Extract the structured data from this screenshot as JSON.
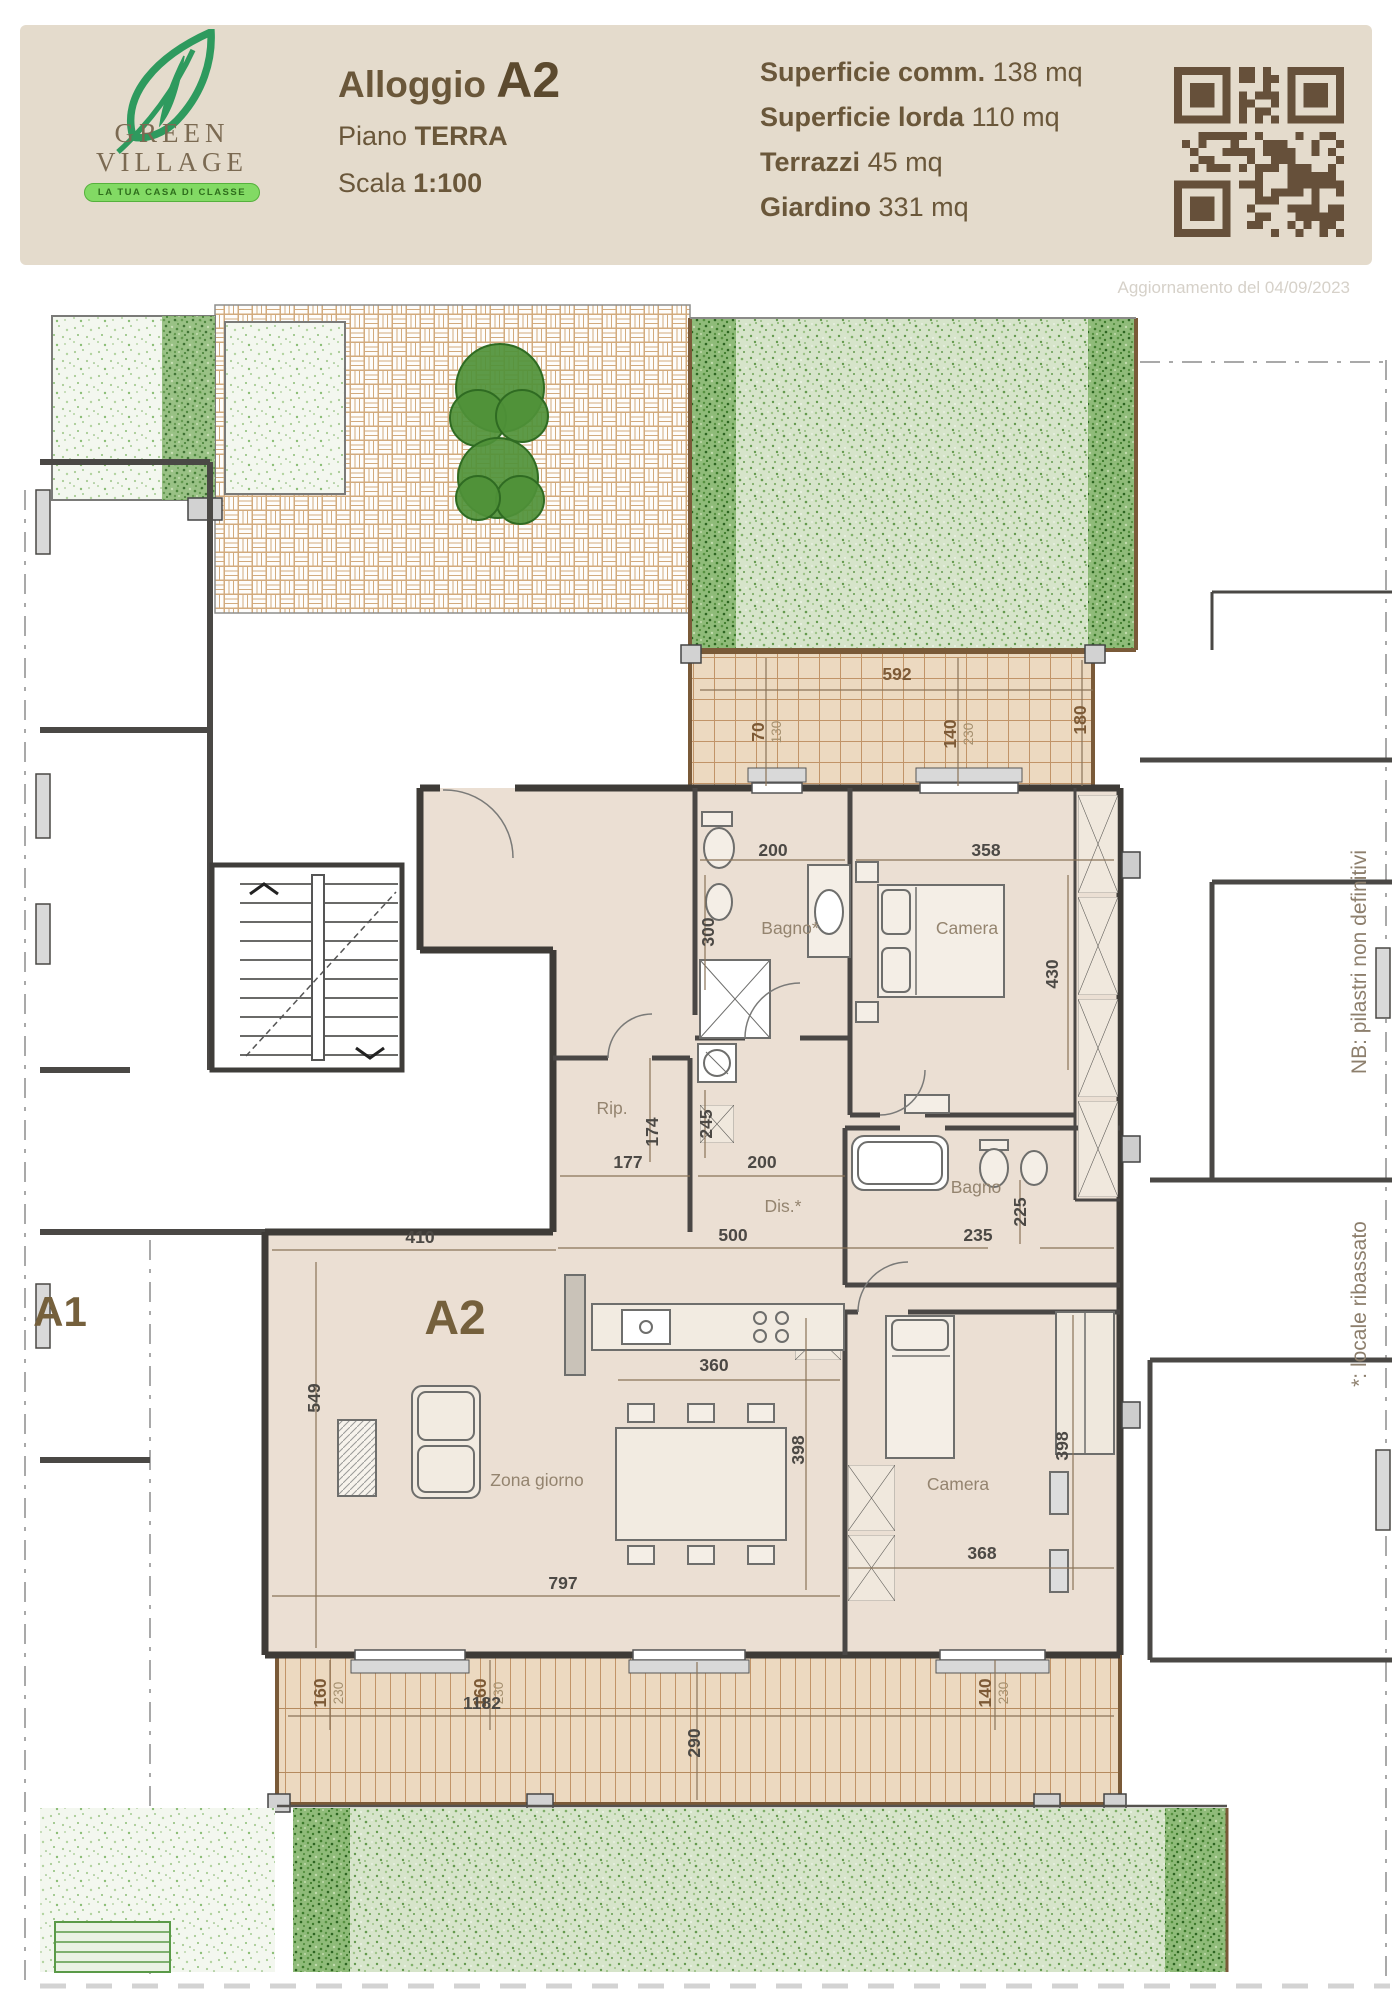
{
  "header": {
    "logo": {
      "name_line1": "GREEN",
      "name_line2": "VILLAGE",
      "tagline": "LA TUA CASA DI CLASSE"
    },
    "title": {
      "label": "Alloggio",
      "value": "A2"
    },
    "floor": {
      "label": "Piano",
      "value": "TERRA"
    },
    "scale": {
      "label": "Scala",
      "value": "1:100"
    },
    "stats": [
      {
        "label": "Superficie comm.",
        "value": "138 mq"
      },
      {
        "label": "Superficie lorda",
        "value": "110 mq"
      },
      {
        "label": "Terrazzi",
        "value": "45 mq"
      },
      {
        "label": "Giardino",
        "value": "331 mq"
      }
    ],
    "qr_icon": "qr-code"
  },
  "plan": {
    "update_note": "Aggiornamento del 04/09/2023",
    "unit_labels": [
      {
        "t": "A2",
        "x": 455,
        "y": 1034,
        "fs": 48
      },
      {
        "t": "A1",
        "x": 60,
        "y": 1026,
        "fs": 42
      }
    ],
    "rooms": [
      {
        "t": "Bagno*",
        "x": 790,
        "y": 634
      },
      {
        "t": "Camera",
        "x": 967,
        "y": 634
      },
      {
        "t": "Rip.",
        "x": 612,
        "y": 814
      },
      {
        "t": "Dis.*",
        "x": 783,
        "y": 912
      },
      {
        "t": "Bagno",
        "x": 976,
        "y": 893
      },
      {
        "t": "Zona giorno",
        "x": 537,
        "y": 1186
      },
      {
        "t": "Camera",
        "x": 958,
        "y": 1190
      }
    ],
    "dimensions": [
      {
        "t": "592",
        "x": 897,
        "y": 380,
        "c": "b"
      },
      {
        "t": "70",
        "t2": "130",
        "x": 764,
        "y": 432,
        "r": 1,
        "c": "b"
      },
      {
        "t": "140",
        "t2": "230",
        "x": 956,
        "y": 434,
        "r": 1,
        "c": "b"
      },
      {
        "t": "180",
        "x": 1086,
        "y": 420,
        "r": 1,
        "c": "b"
      },
      {
        "t": "200",
        "x": 773,
        "y": 556,
        "c": "g"
      },
      {
        "t": "358",
        "x": 986,
        "y": 556,
        "c": "g"
      },
      {
        "t": "300",
        "x": 714,
        "y": 632,
        "r": 1,
        "c": "g"
      },
      {
        "t": "430",
        "x": 1058,
        "y": 674,
        "r": 1,
        "c": "g"
      },
      {
        "t": "174",
        "x": 658,
        "y": 832,
        "r": 1,
        "c": "g"
      },
      {
        "t": "245",
        "x": 712,
        "y": 824,
        "r": 1,
        "c": "g"
      },
      {
        "t": "177",
        "x": 628,
        "y": 868,
        "c": "g"
      },
      {
        "t": "200",
        "x": 762,
        "y": 868,
        "c": "g"
      },
      {
        "t": "500",
        "x": 733,
        "y": 941,
        "c": "g"
      },
      {
        "t": "235",
        "x": 978,
        "y": 941,
        "c": "g"
      },
      {
        "t": "225",
        "x": 1026,
        "y": 912,
        "r": 1,
        "c": "g"
      },
      {
        "t": "410",
        "x": 420,
        "y": 943,
        "c": "g"
      },
      {
        "t": "549",
        "x": 320,
        "y": 1098,
        "r": 1,
        "c": "g"
      },
      {
        "t": "360",
        "x": 714,
        "y": 1071,
        "c": "g"
      },
      {
        "t": "398",
        "x": 804,
        "y": 1150,
        "r": 1,
        "c": "g"
      },
      {
        "t": "398",
        "x": 1068,
        "y": 1146,
        "r": 1,
        "c": "g"
      },
      {
        "t": "368",
        "x": 982,
        "y": 1259,
        "c": "g"
      },
      {
        "t": "797",
        "x": 563,
        "y": 1289,
        "c": "g"
      },
      {
        "t": "160",
        "t2": "230",
        "x": 326,
        "y": 1393,
        "r": 1,
        "c": "b"
      },
      {
        "t": "160",
        "t2": "230",
        "x": 486,
        "y": 1393,
        "r": 1,
        "c": "b"
      },
      {
        "t": "140",
        "t2": "230",
        "x": 991,
        "y": 1393,
        "r": 1,
        "c": "b"
      },
      {
        "t": "1182",
        "x": 482,
        "y": 1409,
        "c": "g"
      },
      {
        "t": "290",
        "x": 700,
        "y": 1443,
        "r": 1,
        "c": "g"
      }
    ],
    "side_notes": [
      {
        "t": "NB: pilastri non definitivi",
        "x": 1366,
        "y": 662
      },
      {
        "t": "*: locale ribassato",
        "x": 1366,
        "y": 1004
      }
    ]
  },
  "colors": {
    "accent_green": "#2e9a5e",
    "header_text": "#6a573a",
    "terrace_dim": "#7d5a36",
    "interior_dim": "#4c4945"
  }
}
